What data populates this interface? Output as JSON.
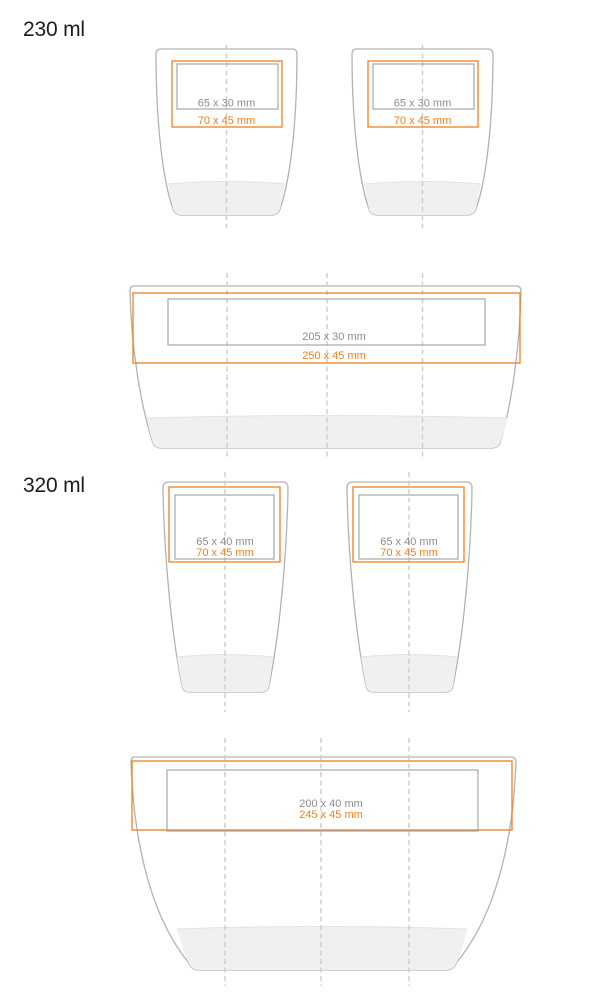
{
  "diagram_title": "cup print area specification",
  "colors": {
    "accent_orange": "#ef811d",
    "print_area_gray": "#a6a6a6",
    "label_gray": "#8c8c8c",
    "cup_outline": "#b3b3b3",
    "cup_base_fill": "#f0f0f0",
    "centerline_gray": "#cccccc",
    "heading_text": "#1c1c1c"
  },
  "sections": [
    {
      "label": "230 ml",
      "front": {
        "print_area": "65 x 30 mm",
        "max_area": "70 x 45 mm"
      },
      "wrap": {
        "print_area": "205 x 30 mm",
        "max_area": "250 x 45 mm"
      }
    },
    {
      "label": "320 ml",
      "front": {
        "print_area": "65 x 40 mm",
        "max_area": "70 x 45 mm"
      },
      "wrap": {
        "print_area": "200 x 40 mm",
        "max_area": "245 x 45 mm"
      }
    }
  ]
}
